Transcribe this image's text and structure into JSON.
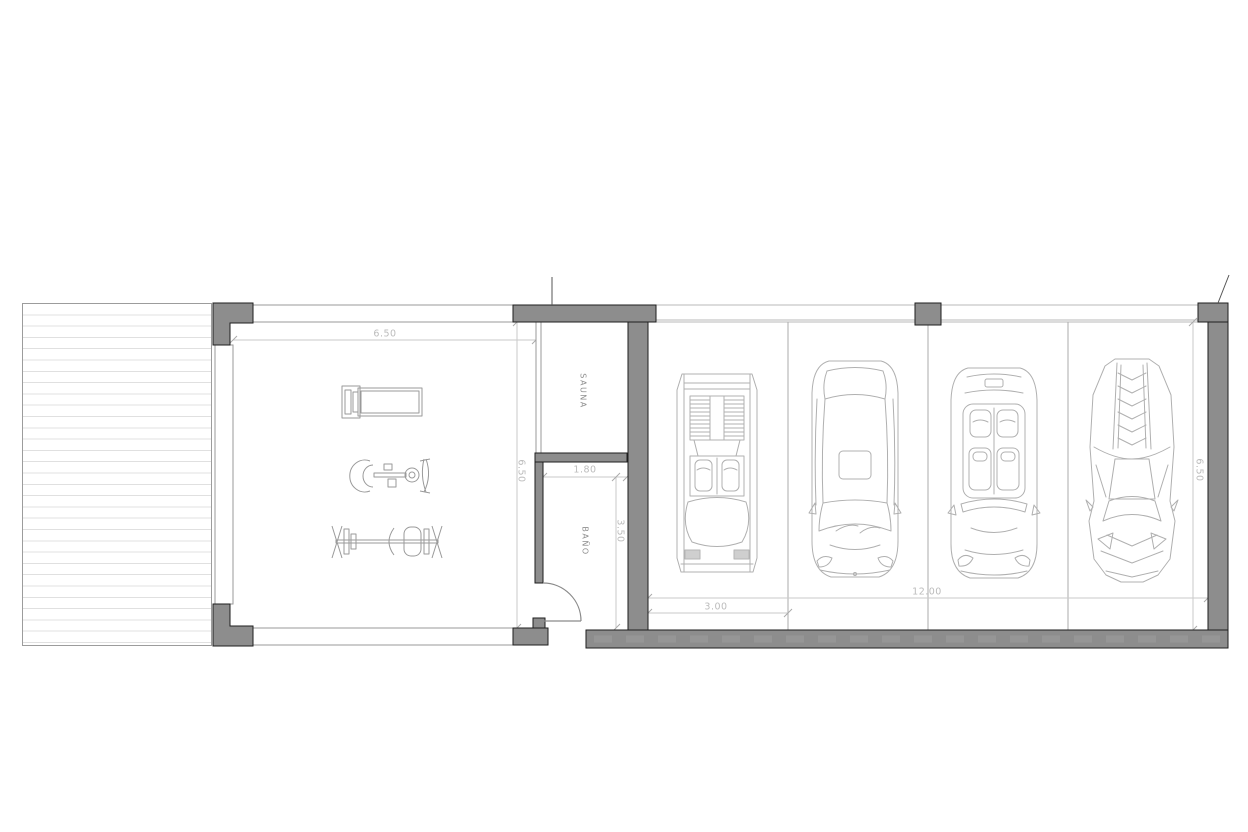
{
  "dims": {
    "gym_width": "6.50",
    "gym_depth": "6.50",
    "bano_width": "1.80",
    "bano_depth": "3.50",
    "parking_space_width": "3.00",
    "garage_width": "12.00",
    "garage_depth": "6.50"
  },
  "labels": {
    "sauna": "SAUNA",
    "bano": "BAÑO"
  },
  "icons": {
    "gym_equipment": [
      "treadmill-icon",
      "cable-machine-icon",
      "bench-press-icon"
    ],
    "garage_cars": [
      "classic-supercar-top-icon",
      "sedan-top-icon",
      "convertible-top-icon",
      "angular-supercar-top-icon"
    ]
  },
  "colors": {
    "wall_fill": "#8d8d8d",
    "wall_outline": "#1e1e1e",
    "dim_text": "#bcbcbc",
    "room_text": "#8f8f8f",
    "car_line": "#b0b0b0",
    "deck_line": "#e0e0e0"
  }
}
